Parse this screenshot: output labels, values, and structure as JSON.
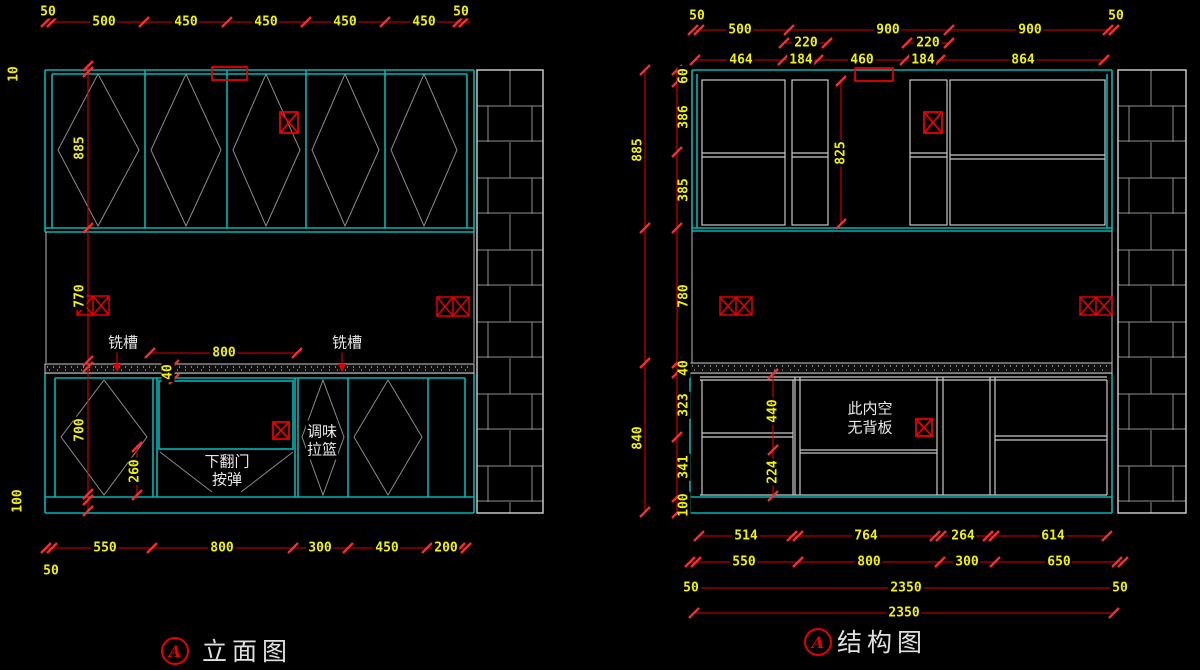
{
  "titles": {
    "left_badge": "A",
    "left": "立面图",
    "right_badge": "A",
    "right": "结构图"
  },
  "left_view": {
    "dims_top": [
      "50",
      "500",
      "450",
      "450",
      "450",
      "450",
      "50"
    ],
    "dims_left": [
      "10",
      "885",
      "770",
      "700",
      "100"
    ],
    "dims_bottom": [
      "550",
      "800",
      "300",
      "450",
      "200"
    ],
    "dim_bottom_offset": "50",
    "dim_800": "800",
    "dim_40": "40",
    "dim_260": "260",
    "label_groove_left": "铣槽",
    "label_groove_right": "铣槽",
    "label_flip_door_line1": "下翻门",
    "label_flip_door_line2": "按弹",
    "label_spice_line1": "调味",
    "label_spice_line2": "拉篮"
  },
  "right_view": {
    "dims_top_row1": [
      "50",
      "500",
      "220",
      "900",
      "220",
      "900",
      "50"
    ],
    "dims_top_row2": [
      "464",
      "184",
      "460",
      "184",
      "864"
    ],
    "dims_left_outer": [
      "885",
      "840"
    ],
    "dims_left_inner": [
      "60",
      "386",
      "385",
      "780",
      "40",
      "323",
      "341",
      "100"
    ],
    "dim_825": "825",
    "dim_440": "440",
    "dim_224": "224",
    "label_note_line1": "此内空",
    "label_note_line2": "无背板",
    "dims_bottom_row1": [
      "514",
      "764",
      "264",
      "614"
    ],
    "dims_bottom_row2": [
      "550",
      "800",
      "300",
      "650"
    ],
    "dims_bottom_row3": [
      "50",
      "2350",
      "50"
    ],
    "dims_bottom_row4": [
      "2350"
    ]
  }
}
